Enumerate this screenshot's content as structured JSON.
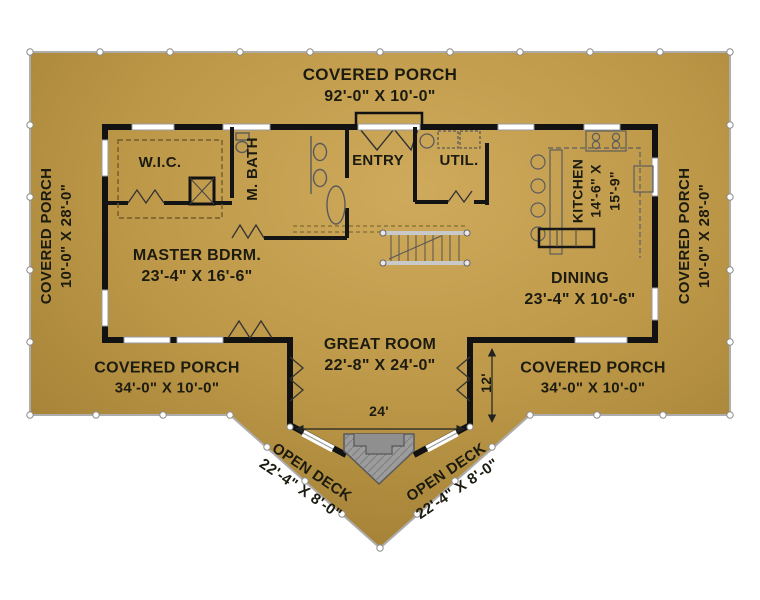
{
  "labels": {
    "porch_top": {
      "name": "COVERED PORCH",
      "dims": "92'-0\" X 10'-0\""
    },
    "porch_left": {
      "name": "COVERED PORCH",
      "dims": "10'-0\" X 28'-0\""
    },
    "porch_right": {
      "name": "COVERED PORCH",
      "dims": "10'-0\" X 28'-0\""
    },
    "porch_bottom_left": {
      "name": "COVERED PORCH",
      "dims": "34'-0\" X 10'-0\""
    },
    "porch_bottom_right": {
      "name": "COVERED PORCH",
      "dims": "34'-0\" X 10'-0\""
    },
    "deck_left": {
      "name": "OPEN DECK",
      "dims": "22'-4\" X 8'-0\""
    },
    "deck_right": {
      "name": "OPEN DECK",
      "dims": "22'-4\" X 8'-0\""
    },
    "wic": {
      "name": "W.I.C."
    },
    "master_bath": {
      "name": "M. BATH"
    },
    "entry": {
      "name": "ENTRY"
    },
    "utility": {
      "name": "UTIL."
    },
    "kitchen": {
      "name": "KITCHEN",
      "dims_line1": "14'-6\" X",
      "dims_line2": "15'-9\""
    },
    "master_bedroom": {
      "name": "MASTER BDRM.",
      "dims": "23'-4\" X 16'-6\""
    },
    "dining": {
      "name": "DINING",
      "dims": "23'-4\" X 10'-6\""
    },
    "great_room": {
      "name": "GREAT ROOM",
      "dims": "22'-8\" X 24'-0\""
    },
    "dim_great_width": "24'",
    "dim_great_side": "12'"
  },
  "colors": {
    "page_background": "#ffffff",
    "floor_light": "#cea95b",
    "floor_mid": "#bd9848",
    "floor_dark": "#99772f",
    "wall": "#121212",
    "text": "#1c1b10",
    "fireplace": "#9c9c9c",
    "outline": "#adadad"
  }
}
